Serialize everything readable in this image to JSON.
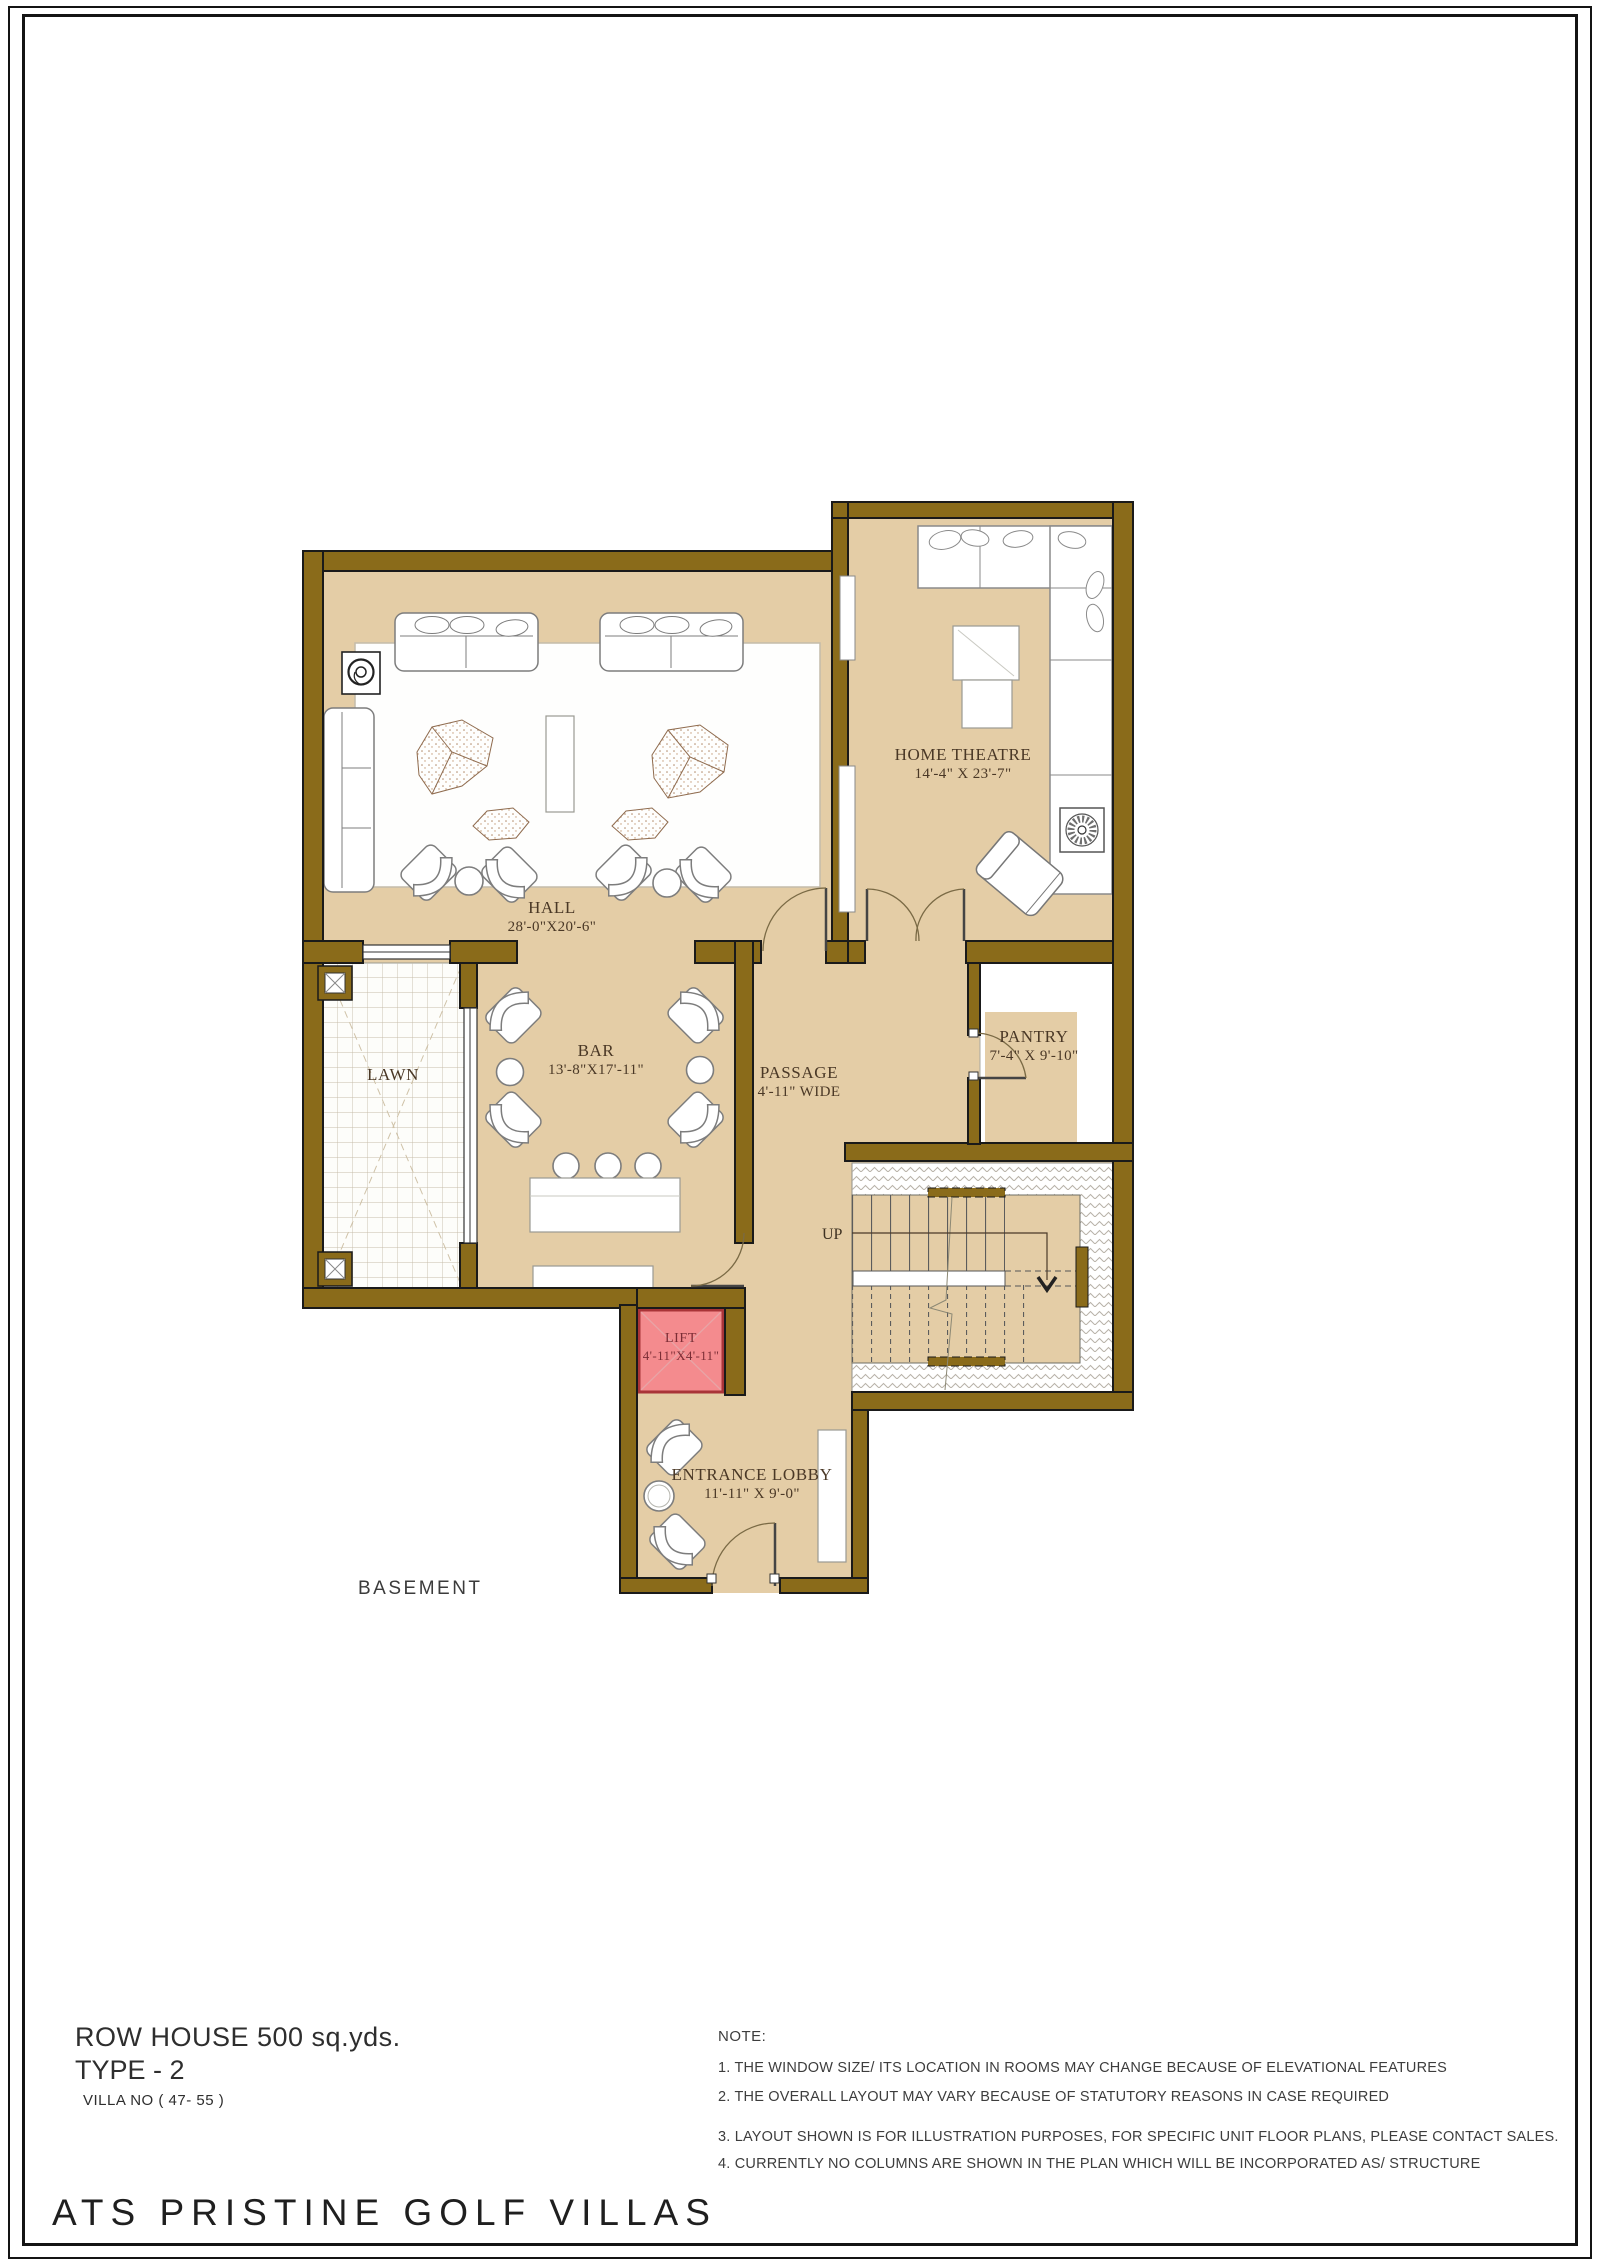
{
  "page": {
    "project_title": "ATS PRISTINE GOLF VILLAS",
    "plan_title": "ROW HOUSE 500 sq.yds.",
    "plan_type": "TYPE - 2",
    "villa_no": "VILLA NO ( 47- 55 )",
    "floor_label": "BASEMENT"
  },
  "notes": {
    "heading": "NOTE:",
    "items": [
      "1. THE WINDOW SIZE/ ITS LOCATION IN ROOMS MAY CHANGE BECAUSE OF ELEVATIONAL FEATURES",
      "2. THE OVERALL LAYOUT MAY VARY BECAUSE OF STATUTORY REASONS IN CASE REQUIRED",
      "3. LAYOUT SHOWN IS FOR ILLUSTRATION PURPOSES, FOR SPECIFIC UNIT FLOOR PLANS, PLEASE CONTACT SALES.",
      "4. CURRENTLY NO COLUMNS ARE SHOWN IN THE PLAN WHICH WILL BE INCORPORATED AS/ STRUCTURE"
    ]
  },
  "rooms": {
    "hall": {
      "name": "HALL",
      "dims": "28'-0\"X20'-6\""
    },
    "home_theatre": {
      "name": "HOME THEATRE",
      "dims": "14'-4\" X 23'-7\""
    },
    "bar": {
      "name": "BAR",
      "dims": "13'-8\"X17'-11\""
    },
    "lawn": {
      "name": "LAWN",
      "dims": ""
    },
    "passage": {
      "name": "PASSAGE",
      "dims": "4'-11\" WIDE"
    },
    "pantry": {
      "name": "PANTRY",
      "dims": "7'-4\" X 9'-10\""
    },
    "lift": {
      "name": "LIFT",
      "dims": "4'-11\"X4'-11\""
    },
    "entrance_lobby": {
      "name": "ENTRANCE LOBBY",
      "dims": "11'-11\" X 9'-0\""
    }
  },
  "stairs": {
    "up_label": "UP"
  },
  "colors": {
    "wall": "#8a6b1a",
    "wall_outline": "#1a1a1a",
    "floor": "#e4cda6",
    "lift_fill": "#f48b8e",
    "lift_border": "#a93438",
    "label_text": "#4a3826",
    "lift_text": "#7b2d35"
  }
}
